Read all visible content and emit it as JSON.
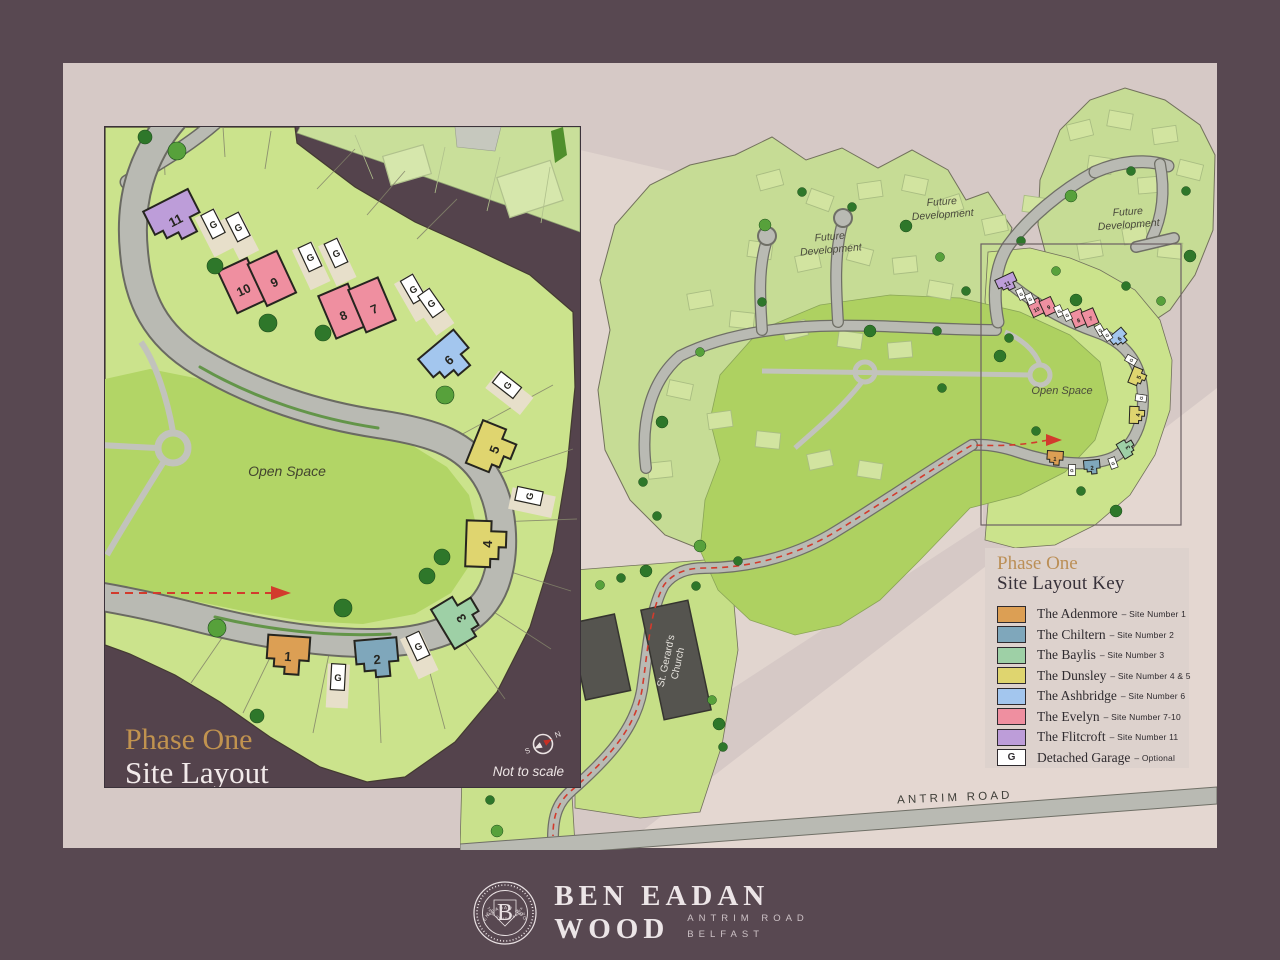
{
  "page": {
    "frame_color": "#584851",
    "inner_color": "#d6c9c6"
  },
  "inset": {
    "title_line1": "Phase One",
    "title_line2": "Site Layout",
    "open_space": "Open Space",
    "not_to_scale": "Not to scale",
    "compass_n": "N",
    "compass_s": "S",
    "garage_letter": "G",
    "houses": [
      {
        "num": "11",
        "color": "#BD9DD9"
      },
      {
        "nums": [
          "10",
          "9"
        ],
        "color": "#EF8FA0"
      },
      {
        "nums": [
          "8",
          "7"
        ],
        "color": "#EF8FA0"
      },
      {
        "num": "6",
        "color": "#A3C6EE"
      },
      {
        "num": "5",
        "color": "#DFD56F"
      },
      {
        "num": "4",
        "color": "#DFD56F"
      },
      {
        "num": "3",
        "color": "#9ED0A6"
      },
      {
        "num": "2",
        "color": "#7FA7BB"
      },
      {
        "num": "1",
        "color": "#DC9F54"
      }
    ]
  },
  "overview": {
    "future_line1": "Future",
    "future_line2": "Development",
    "open_space": "Open Space",
    "church_line1": "St. Gerard's",
    "church_line2": "Church",
    "antrim_road": "ANTRIM ROAD"
  },
  "legend": {
    "title_accent": "Phase One",
    "title": "Site Layout Key",
    "rows": [
      {
        "name": "The Adenmore",
        "desc": "Site Number 1",
        "color": "#DC9F54"
      },
      {
        "name": "The Chiltern",
        "desc": "Site Number 2",
        "color": "#7FA7BB"
      },
      {
        "name": "The Baylis",
        "desc": "Site Number 3",
        "color": "#9ED0A6"
      },
      {
        "name": "The Dunsley",
        "desc": "Site Number 4 & 5",
        "color": "#DFD56F"
      },
      {
        "name": "The Ashbridge",
        "desc": "Site Number 6",
        "color": "#A3C6EE"
      },
      {
        "name": "The Evelyn",
        "desc": "Site Number 7-10",
        "color": "#EF8FA0"
      },
      {
        "name": "The Flitcroft",
        "desc": "Site Number 11",
        "color": "#FFFFFF",
        "swatch_color": "#BD9DD9"
      },
      {
        "name": "Detached Garage",
        "desc": "Optional",
        "color": "#FFFFFF",
        "swatch_letter": "G"
      }
    ]
  },
  "footer": {
    "brand_line1": "BEN EADAN",
    "brand_line2": "WOOD",
    "sub_line1": "ANTRIM ROAD",
    "sub_line2": "BELFAST",
    "badge_letter": "B",
    "badge_top": "BEN EADAN WOOD",
    "badge_bottom": "ANTRIM ROAD · BELFAST",
    "badge_left": "Est",
    "badge_right": "2024"
  }
}
